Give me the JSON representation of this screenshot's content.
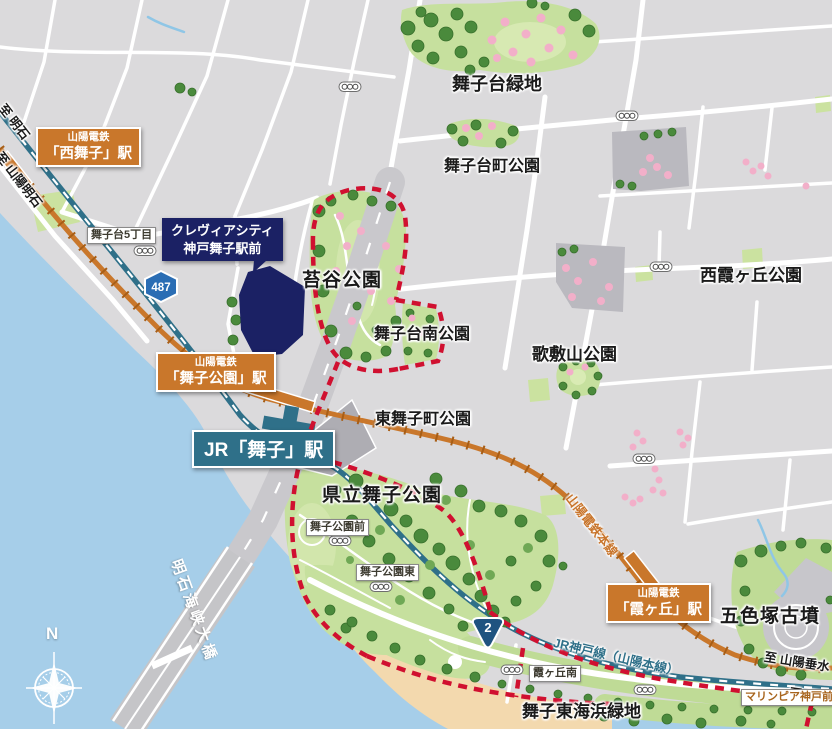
{
  "parks": [
    {
      "id": "maikodai-ryokuchi",
      "text": "舞子台緑地"
    },
    {
      "id": "maikodai-cho-koen",
      "text": "舞子台町公園"
    },
    {
      "id": "nishi-kasumigaoka-koen",
      "text": "西霞ヶ丘公園"
    },
    {
      "id": "kokedani-koen",
      "text": "苔谷公園"
    },
    {
      "id": "maikodai-minami-koen",
      "text": "舞子台南公園"
    },
    {
      "id": "utashikiyama-koen",
      "text": "歌敷山公園"
    },
    {
      "id": "higashi-maikocho-koen",
      "text": "東舞子町公園"
    },
    {
      "id": "kenritsu-maiko-koen",
      "text": "県立舞子公園"
    },
    {
      "id": "goshikizuka-kofun",
      "text": "五色塚古墳"
    },
    {
      "id": "maiko-higashi-kaihin-ryokuchi",
      "text": "舞子東海浜緑地"
    }
  ],
  "stations": [
    {
      "id": "nishi-maiko",
      "company": "山陽電鉄",
      "name": "「西舞子」駅"
    },
    {
      "id": "maiko-koen",
      "company": "山陽電鉄",
      "name": "「舞子公園」駅"
    },
    {
      "id": "kasumigaoka",
      "company": "山陽電鉄",
      "name": "「霞ヶ丘」駅"
    },
    {
      "id": "jr-maiko",
      "name": "JR「舞子」駅"
    }
  ],
  "landmark": {
    "line1": "クレヴィアシティ",
    "line2": "神戸舞子駅前"
  },
  "signals": [
    {
      "text": "舞子台5丁目"
    },
    {
      "text": "舞子公園前"
    },
    {
      "text": "舞子公園東"
    },
    {
      "text": "霞ヶ丘南"
    },
    {
      "text": "マリンピア神戸前"
    }
  ],
  "directions": [
    {
      "text": "至 明石"
    },
    {
      "text": "至 山陽明石"
    },
    {
      "text": "至 山陽垂水"
    },
    {
      "text": "至 須磨"
    }
  ],
  "railway_lines": [
    {
      "text": "山陽電鉄本線"
    },
    {
      "text": "JR神戸線（山陽本線）"
    }
  ],
  "bridge": {
    "name": "明石海峡大橋"
  },
  "badges": {
    "route487": "487",
    "route2": "2"
  },
  "compass": {
    "north": "N"
  },
  "colors": {
    "sea": "#A6CEE9",
    "land": "#DBDADC",
    "park_green": "#C6E09E",
    "tree_green": "#4A8A3C",
    "blossom_pink": "#F2AFC9",
    "sanyo_orange": "#C9772B",
    "jr_teal": "#2F7089",
    "boundary_red": "#D01030",
    "landmark_navy": "#1B2164",
    "sand": "#F3D9AE",
    "route_badge_blue": "#2A6DB4",
    "expressway_gray": "#C9C8CC"
  }
}
